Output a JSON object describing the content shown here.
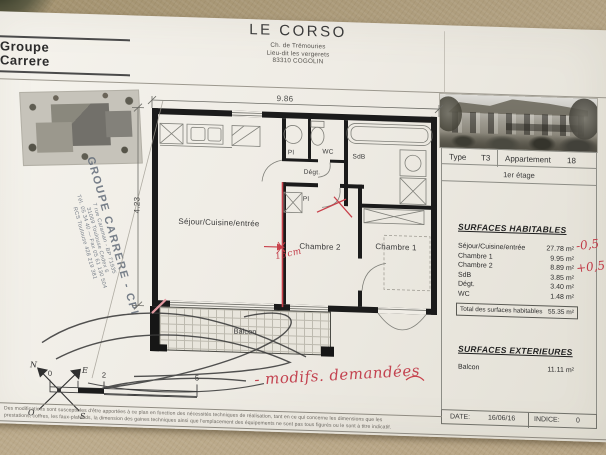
{
  "colors": {
    "annotation_red": "#c23c48",
    "stamp_ink": "#5d6775",
    "paper": "#f0ede6",
    "background_fabric": "#b3a283",
    "wall_black": "#1b1b1b"
  },
  "header": {
    "logo_line1": "Groupe",
    "logo_line2": "Carrere",
    "title": "LE CORSO",
    "address1": "Ch. de Trémouries",
    "address2": "Lieu-dit les vergerets",
    "address3": "83310 COGOLIN"
  },
  "info": {
    "type_label": "Type",
    "type_value": "T3",
    "apartment_label": "Appartement",
    "apartment_value": "18",
    "floor": "1er étage"
  },
  "surfaces_habitables": {
    "title": "SURFACES HABITABLES",
    "rows": [
      {
        "label": "Séjour/Cuisine/entrée",
        "value": "27.78 m²"
      },
      {
        "label": "Chambre 1",
        "value": "9.95 m²"
      },
      {
        "label": "Chambre 2",
        "value": "8.89 m²"
      },
      {
        "label": "SdB",
        "value": "3.85 m²"
      },
      {
        "label": "Dégt.",
        "value": "3.40 m²"
      },
      {
        "label": "WC",
        "value": "1.48 m²"
      }
    ],
    "total_label": "Total des surfaces habitables",
    "total_value": "55.35 m²"
  },
  "surfaces_exterieures": {
    "title": "SURFACES EXTERIEURES",
    "balcon_label": "Balcon",
    "balcon_value": "11.11 m²"
  },
  "footer": {
    "date_label": "DATE:",
    "date_value": "16/06/16",
    "indice_label": "INDICE:",
    "indice_value": "0"
  },
  "plan": {
    "dim_width": "9.86",
    "dim_height": "4.23",
    "room_sejour": "Séjour/Cuisine/entrée",
    "room_chambre1": "Chambre 1",
    "room_chambre2": "Chambre 2",
    "room_wc": "WC",
    "room_sdb": "SdB",
    "room_degt": "Dégt.",
    "room_pl_top": "Pl",
    "room_pl_mid": "Pl",
    "room_balcon": "Balcon",
    "scale_0": "0",
    "scale_1": "1",
    "scale_2": "2",
    "scale_5": "5",
    "compass_n": "N",
    "compass_e": "E",
    "compass_s": "S",
    "compass_o": "O"
  },
  "annotations": {
    "wall_offset": "15cm",
    "modifs": "- modifs. demandées",
    "delta_sejour": "-0,5",
    "delta_chambre2": "+0,5"
  },
  "stamp": {
    "line1": "GROUPE CARRERE - CPI",
    "line2": "7 rue Caraman - BP 71935",
    "line3": "31069 Toulouse Cedex 6",
    "line4": "Tél. 05 34 40 — Fax 05 61 130 504",
    "line5": "RCS Toulouse 428 219 381"
  },
  "disclaimer": {
    "line1": "Des modifications sont susceptibles d'être apportées à ce plan en fonction des nécessités techniques de réalisation, tant en ce qui concerne les dimensions que les",
    "line2": "prestations, coffres, les faux-plafonds, la dimension des gaines techniques ainsi que l'emplacement des équipements ne sont pas tous figurés ou le sont à titre indicatif."
  }
}
